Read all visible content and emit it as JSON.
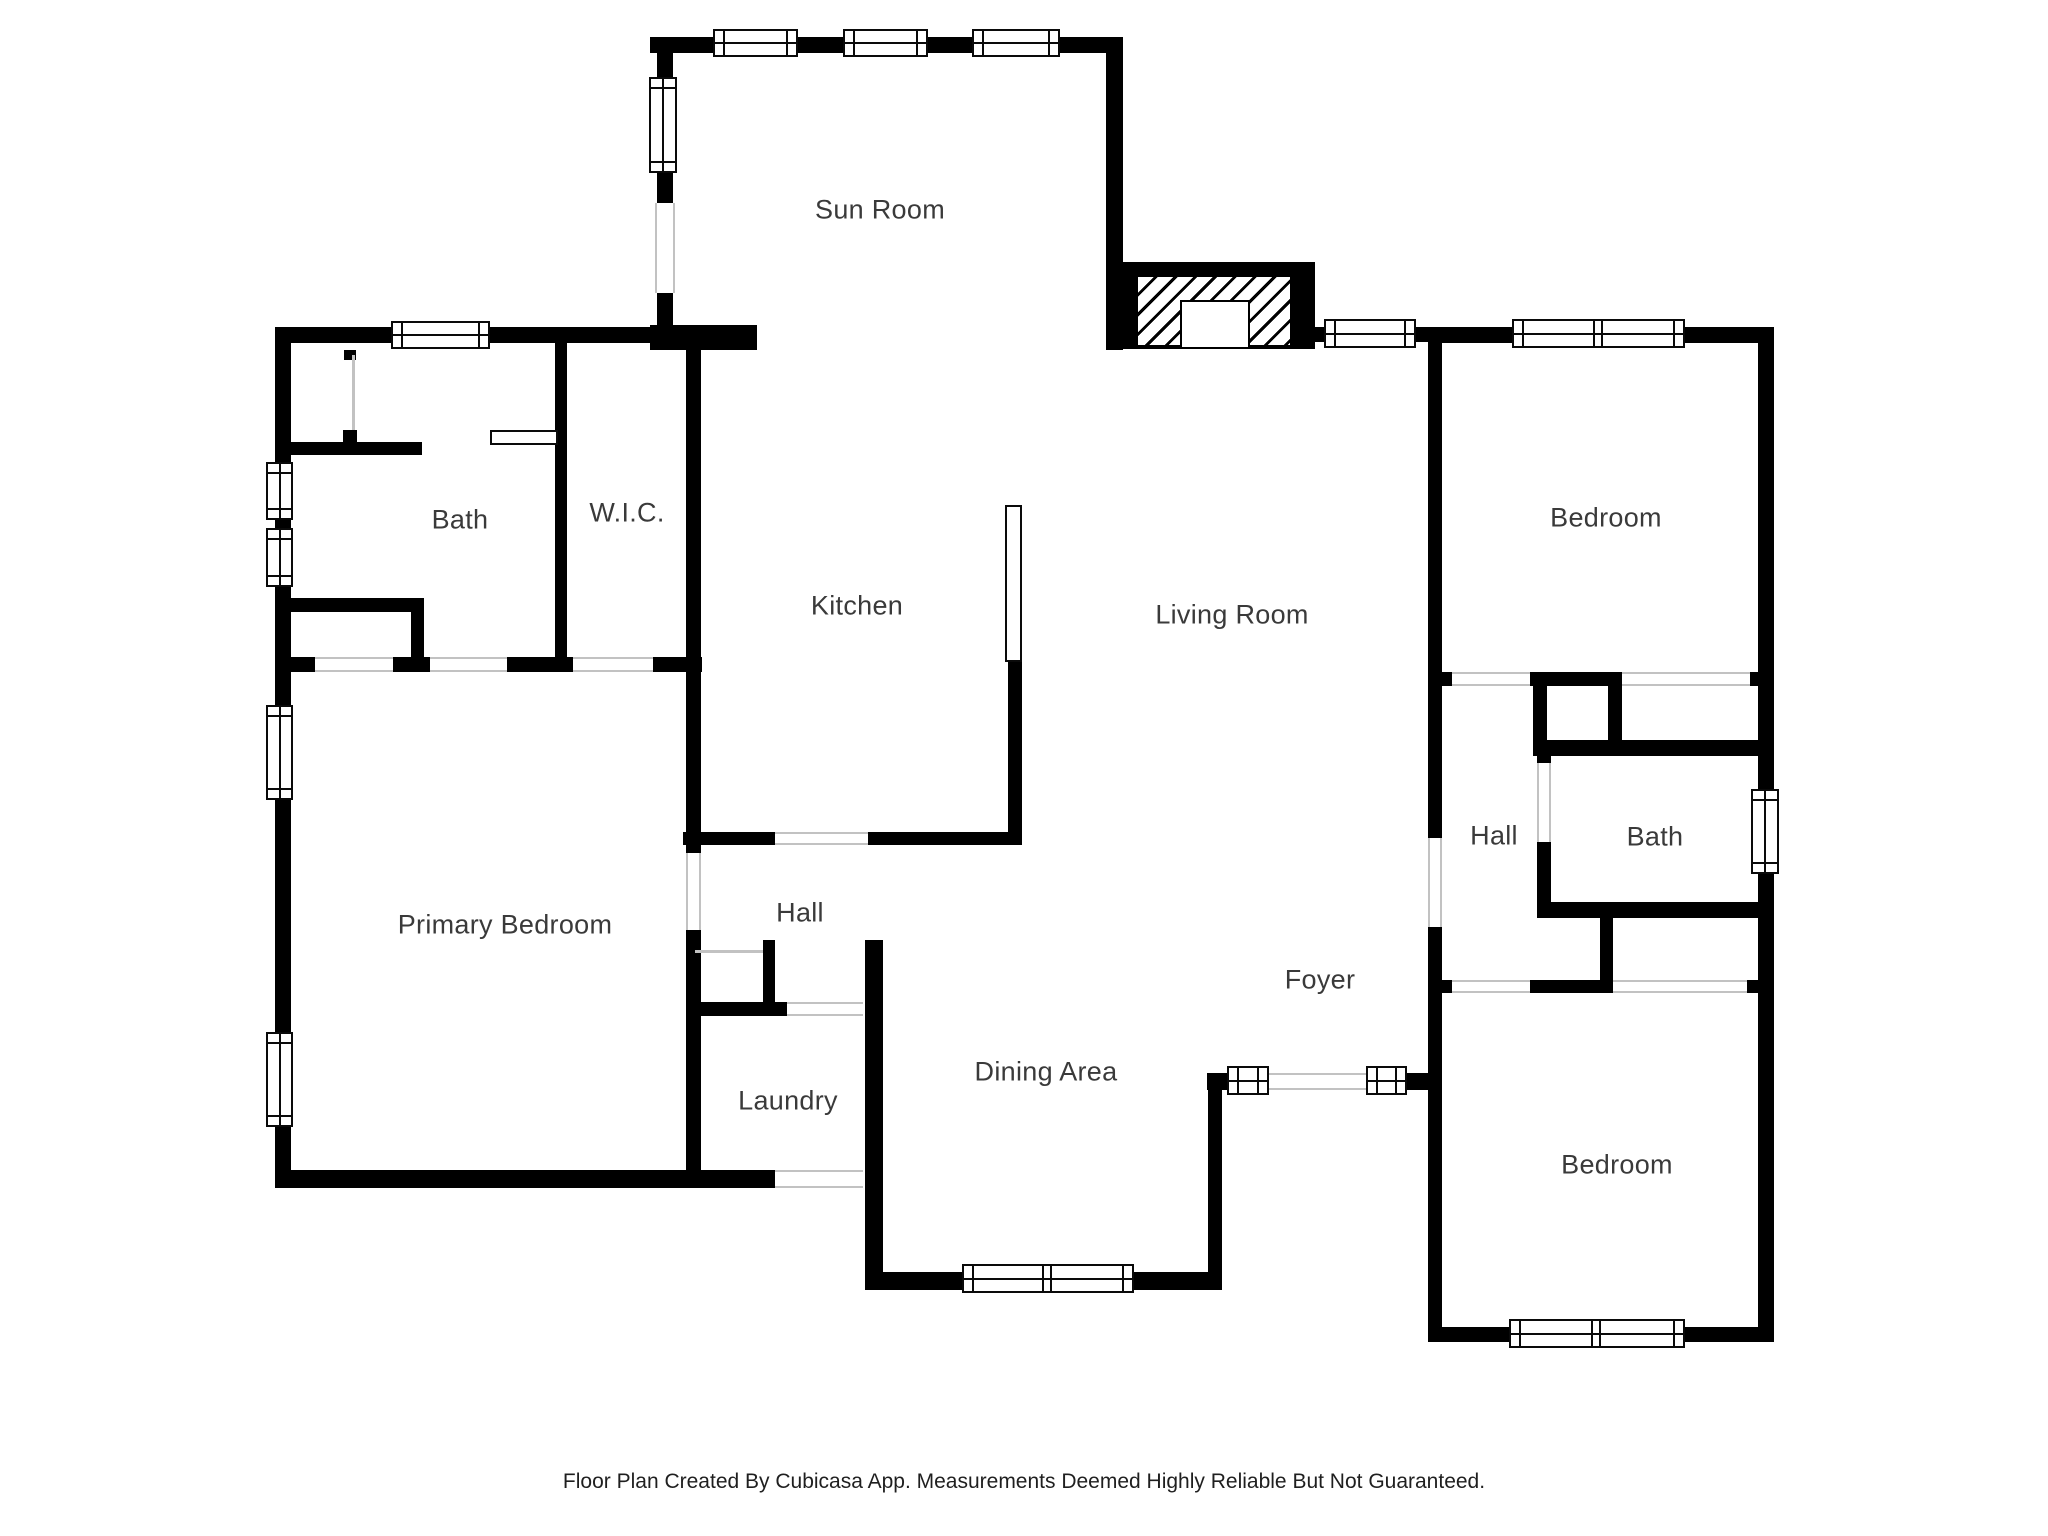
{
  "page": {
    "footer": "Floor Plan Created By Cubicasa App. Measurements Deemed Highly Reliable But Not Guaranteed."
  },
  "colors": {
    "wall": "#000000",
    "floor": "#ffffff",
    "opening_line": "#c2c2c2",
    "label_text": "#3a3a3a"
  },
  "rooms": [
    {
      "id": "sun-room",
      "label": "Sun Room",
      "cx": 880,
      "cy": 210
    },
    {
      "id": "bath-left",
      "label": "Bath",
      "cx": 460,
      "cy": 520
    },
    {
      "id": "wic",
      "label": "W.I.C.",
      "cx": 627,
      "cy": 513
    },
    {
      "id": "kitchen",
      "label": "Kitchen",
      "cx": 857,
      "cy": 606
    },
    {
      "id": "living-room",
      "label": "Living Room",
      "cx": 1232,
      "cy": 615
    },
    {
      "id": "bedroom-top",
      "label": "Bedroom",
      "cx": 1606,
      "cy": 518
    },
    {
      "id": "primary-bedroom",
      "label": "Primary Bedroom",
      "cx": 505,
      "cy": 925
    },
    {
      "id": "hall-center",
      "label": "Hall",
      "cx": 800,
      "cy": 913
    },
    {
      "id": "hall-right",
      "label": "Hall",
      "cx": 1494,
      "cy": 836
    },
    {
      "id": "bath-right",
      "label": "Bath",
      "cx": 1655,
      "cy": 837
    },
    {
      "id": "foyer",
      "label": "Foyer",
      "cx": 1320,
      "cy": 980
    },
    {
      "id": "laundry",
      "label": "Laundry",
      "cx": 788,
      "cy": 1101
    },
    {
      "id": "dining-area",
      "label": "Dining Area",
      "cx": 1046,
      "cy": 1072
    },
    {
      "id": "bedroom-bottom",
      "label": "Bedroom",
      "cx": 1617,
      "cy": 1165
    }
  ],
  "geometry": {
    "walls": [
      [
        650,
        37,
        473,
        16
      ],
      [
        657,
        37,
        16,
        313
      ],
      [
        1106,
        37,
        17,
        313
      ],
      [
        650,
        325,
        107,
        25
      ],
      [
        275,
        327,
        427,
        16
      ],
      [
        275,
        343,
        16,
        845
      ],
      [
        275,
        1170,
        500,
        18
      ],
      [
        344,
        350,
        12,
        10
      ],
      [
        343,
        430,
        14,
        13
      ],
      [
        291,
        442,
        131,
        13
      ],
      [
        291,
        598,
        122,
        14
      ],
      [
        411,
        598,
        13,
        59
      ],
      [
        275,
        657,
        427,
        15
      ],
      [
        555,
        343,
        12,
        314
      ],
      [
        686,
        343,
        15,
        845
      ],
      [
        683,
        832,
        339,
        13
      ],
      [
        1008,
        660,
        14,
        185
      ],
      [
        1307,
        327,
        123,
        15
      ],
      [
        1428,
        327,
        346,
        16
      ],
      [
        1428,
        343,
        14,
        999
      ],
      [
        1758,
        327,
        16,
        1015
      ],
      [
        1428,
        672,
        346,
        14
      ],
      [
        1533,
        672,
        14,
        68
      ],
      [
        1608,
        672,
        14,
        84
      ],
      [
        1533,
        740,
        241,
        16
      ],
      [
        1537,
        740,
        14,
        178
      ],
      [
        1537,
        902,
        237,
        16
      ],
      [
        1600,
        918,
        13,
        75
      ],
      [
        1533,
        980,
        80,
        13
      ],
      [
        1428,
        980,
        346,
        13
      ],
      [
        1428,
        1327,
        346,
        15
      ],
      [
        1207,
        1073,
        223,
        17
      ],
      [
        1208,
        1073,
        14,
        217
      ],
      [
        867,
        1272,
        355,
        18
      ],
      [
        865,
        940,
        18,
        350
      ],
      [
        692,
        1002,
        171,
        14
      ],
      [
        763,
        940,
        12,
        63
      ]
    ],
    "openings": [
      {
        "x": 655,
        "y": 203,
        "w": 20,
        "h": 90,
        "o": "v"
      },
      {
        "x": 315,
        "y": 657,
        "w": 78,
        "h": 15,
        "o": "h"
      },
      {
        "x": 430,
        "y": 657,
        "w": 77,
        "h": 15,
        "o": "h"
      },
      {
        "x": 573,
        "y": 657,
        "w": 80,
        "h": 15,
        "o": "h"
      },
      {
        "x": 686,
        "y": 853,
        "w": 15,
        "h": 77,
        "o": "v"
      },
      {
        "x": 775,
        "y": 832,
        "w": 93,
        "h": 13,
        "o": "h"
      },
      {
        "x": 787,
        "y": 1002,
        "w": 76,
        "h": 14,
        "o": "h"
      },
      {
        "x": 775,
        "y": 1170,
        "w": 88,
        "h": 18,
        "o": "h"
      },
      {
        "x": 1428,
        "y": 838,
        "w": 14,
        "h": 89,
        "o": "v"
      },
      {
        "x": 1452,
        "y": 672,
        "w": 78,
        "h": 14,
        "o": "h"
      },
      {
        "x": 1622,
        "y": 672,
        "w": 128,
        "h": 14,
        "o": "h"
      },
      {
        "x": 1537,
        "y": 763,
        "w": 14,
        "h": 79,
        "o": "v"
      },
      {
        "x": 1452,
        "y": 980,
        "w": 78,
        "h": 13,
        "o": "h"
      },
      {
        "x": 1613,
        "y": 980,
        "w": 134,
        "h": 13,
        "o": "h"
      },
      {
        "x": 1268,
        "y": 1073,
        "w": 99,
        "h": 17,
        "o": "h"
      }
    ],
    "thin_lines": [
      [
        695,
        950,
        68,
        3
      ],
      [
        352,
        355,
        3,
        75
      ]
    ],
    "windows": [
      {
        "x": 713,
        "y": 29,
        "w": 85,
        "h": 28,
        "double": false
      },
      {
        "x": 843,
        "y": 29,
        "w": 85,
        "h": 28,
        "double": false
      },
      {
        "x": 972,
        "y": 29,
        "w": 88,
        "h": 28,
        "double": false
      },
      {
        "x": 649,
        "y": 77,
        "w": 28,
        "h": 96,
        "double": false
      },
      {
        "x": 391,
        "y": 321,
        "w": 99,
        "h": 28,
        "double": false
      },
      {
        "x": 266,
        "y": 462,
        "w": 27,
        "h": 58,
        "double": false
      },
      {
        "x": 266,
        "y": 528,
        "w": 27,
        "h": 59,
        "double": false
      },
      {
        "x": 266,
        "y": 705,
        "w": 27,
        "h": 95,
        "double": false
      },
      {
        "x": 266,
        "y": 1032,
        "w": 27,
        "h": 95,
        "double": false
      },
      {
        "x": 1324,
        "y": 319,
        "w": 92,
        "h": 29,
        "double": false
      },
      {
        "x": 1512,
        "y": 319,
        "w": 173,
        "h": 29,
        "double": true
      },
      {
        "x": 1751,
        "y": 789,
        "w": 28,
        "h": 85,
        "double": false
      },
      {
        "x": 1509,
        "y": 1319,
        "w": 176,
        "h": 29,
        "double": true
      },
      {
        "x": 962,
        "y": 1264,
        "w": 172,
        "h": 29,
        "double": true
      },
      {
        "x": 1227,
        "y": 1066,
        "w": 42,
        "h": 29,
        "double": false
      },
      {
        "x": 1366,
        "y": 1066,
        "w": 41,
        "h": 29,
        "double": false
      }
    ],
    "fixtures": {
      "vanity": [
        490,
        430,
        68,
        15
      ],
      "kitchen_counter": [
        1005,
        505,
        17,
        157
      ],
      "fireplace": {
        "outer": [
          1123,
          262,
          192,
          87
        ],
        "hatch": [
          15,
          15,
          152,
          68
        ],
        "firebox": [
          57,
          38,
          70,
          49
        ]
      }
    }
  }
}
